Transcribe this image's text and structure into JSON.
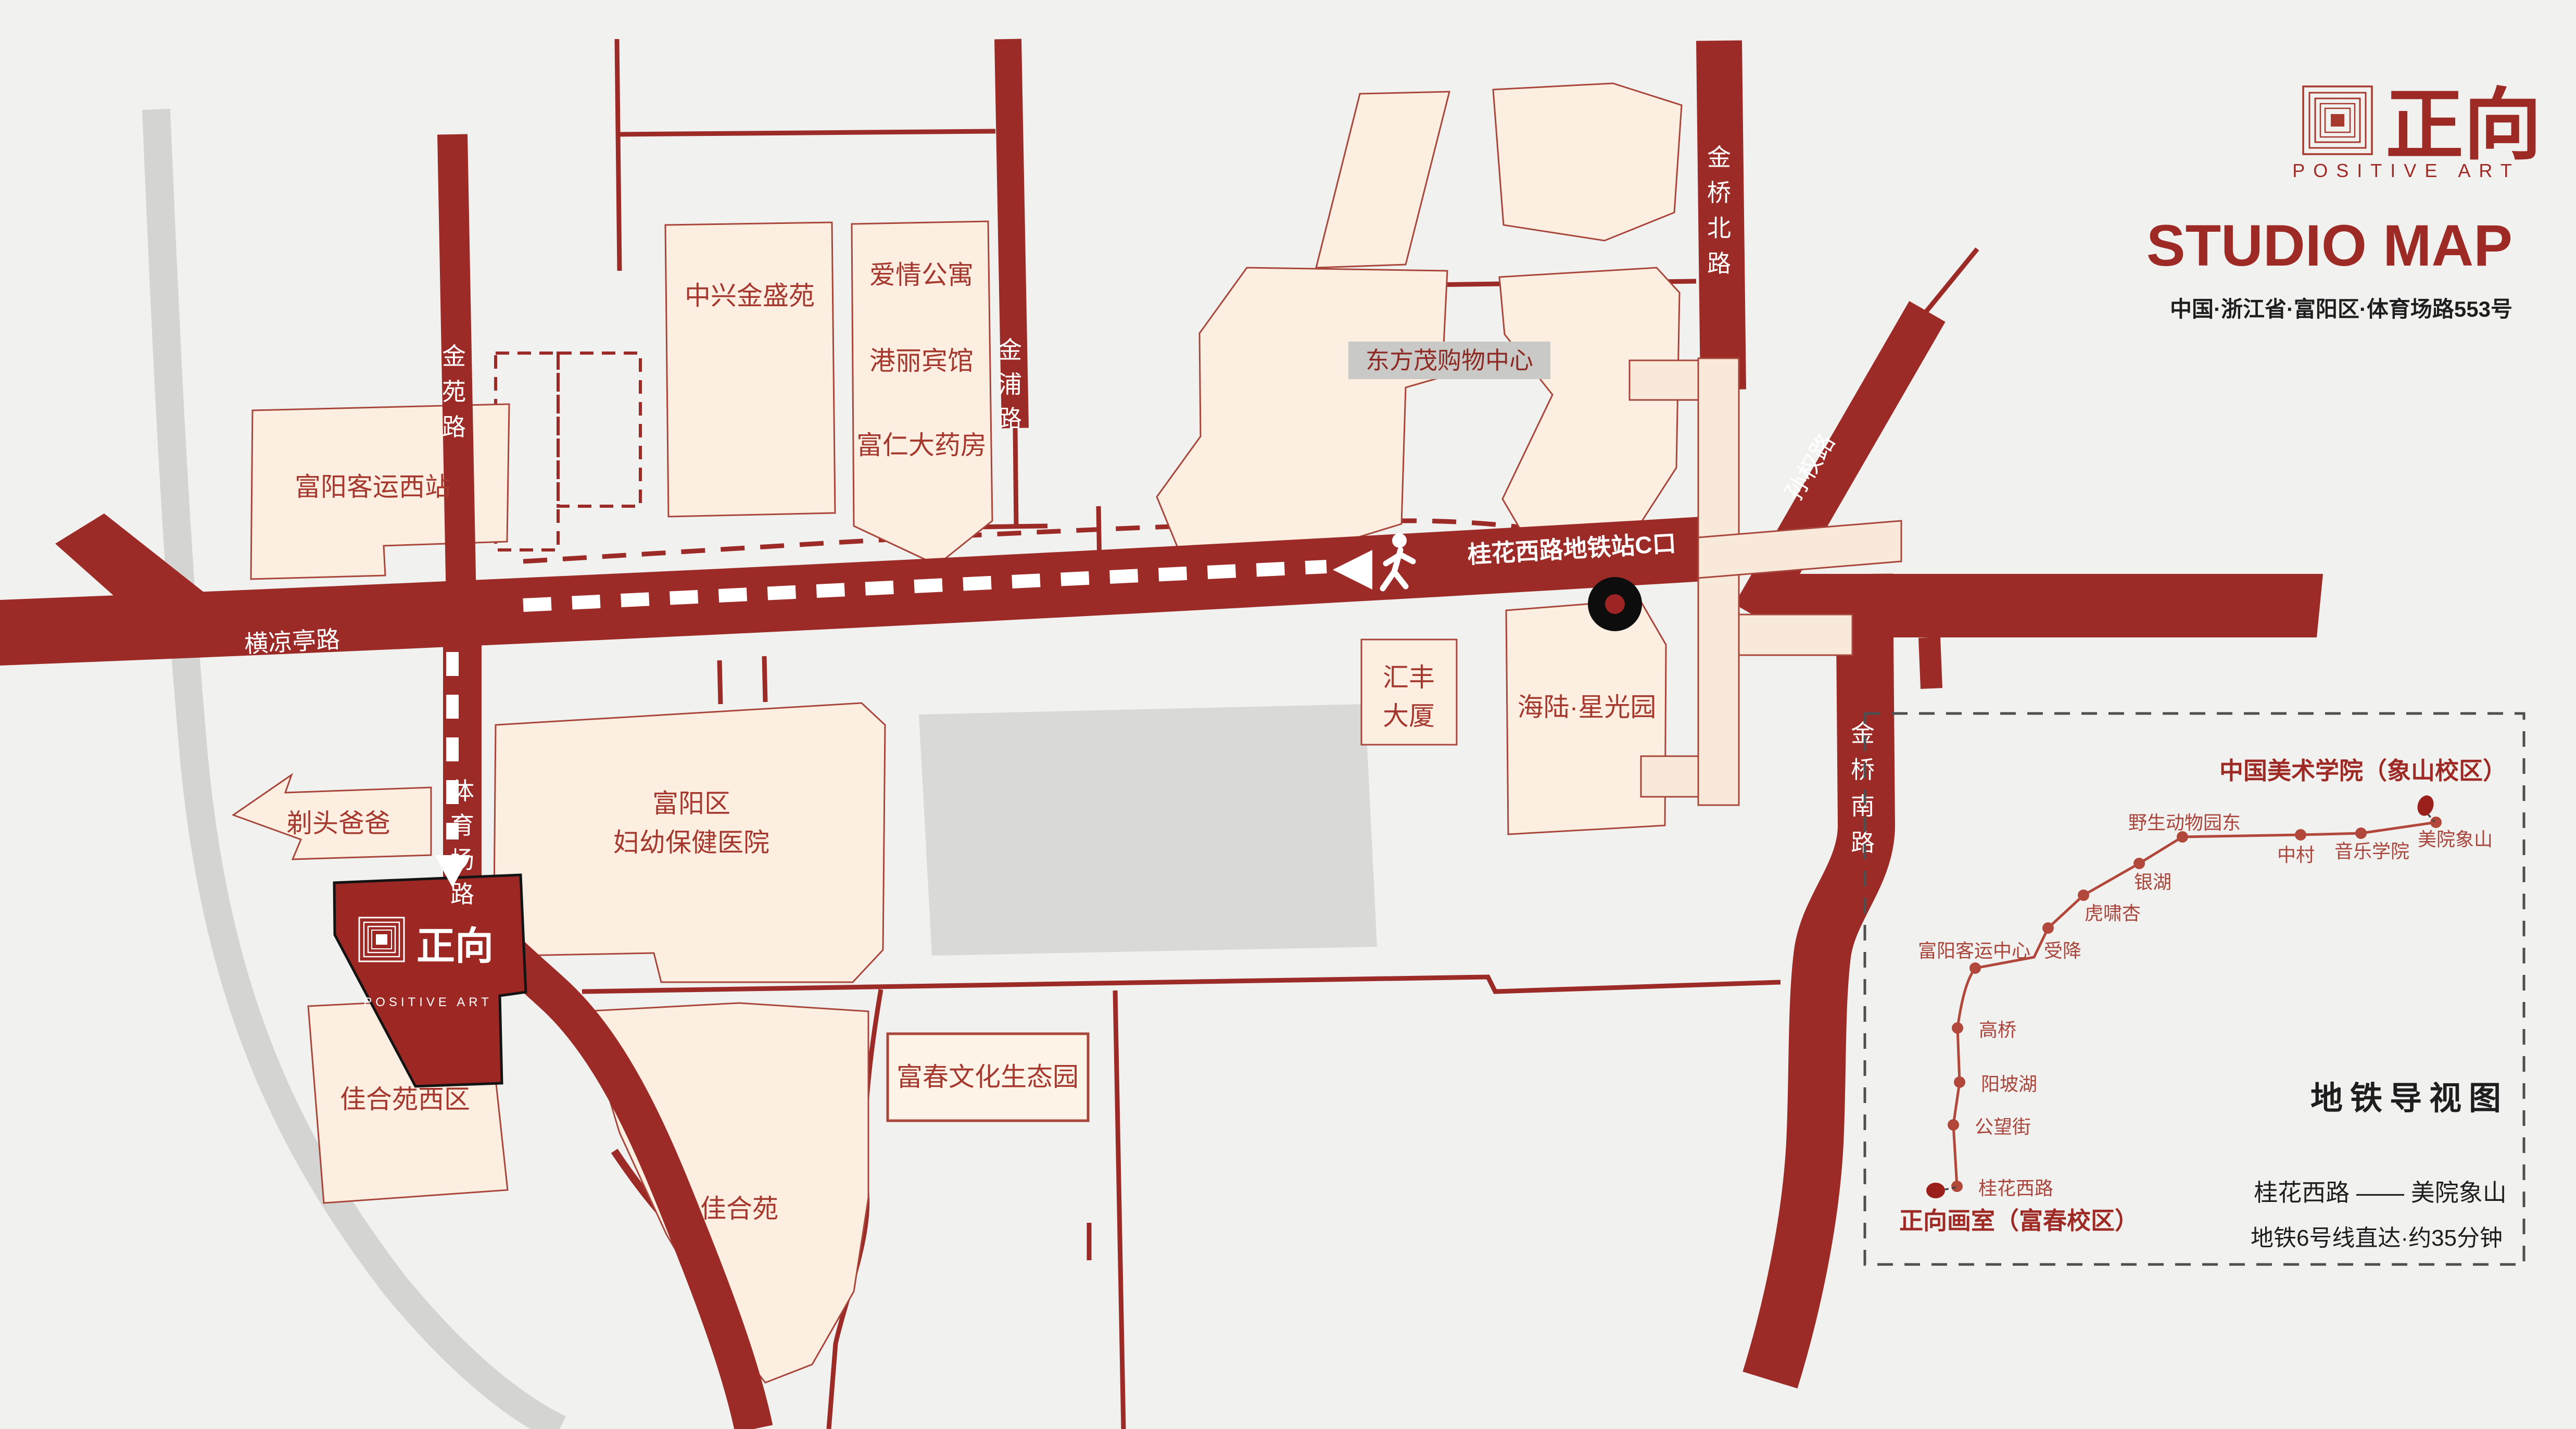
{
  "brand": {
    "name_cn": "正向",
    "name_en": "POSITIVE ART"
  },
  "header": {
    "title": "STUDIO MAP",
    "address": "中国·浙江省·富阳区·体育场路553号"
  },
  "map": {
    "road_labels": {
      "jinyuan": "金苑路",
      "jinpu": "金浦路",
      "jinqiao_north": "金桥北路",
      "sunquan": "孙权路",
      "hengliangting": "横凉亭路",
      "tiyuchang": "体育场路",
      "jinqiao_south": "金桥南路",
      "metro_exit": "桂花西路地铁站C口"
    },
    "buildings": {
      "fuyang_west_bus": "富阳客运西站",
      "zhongxing": "中兴金盛苑",
      "apartment": "爱情公寓",
      "hotel": "港丽宾馆",
      "pharmacy": "富仁大药房",
      "dongfangmao": "东方茂购物中心",
      "huifeng": [
        "汇丰",
        "大厦"
      ],
      "hailu": "海陆·星光园",
      "hospital": [
        "富阳区",
        "妇幼保健医院"
      ],
      "barber": "剃头爸爸",
      "jiaheyuan_west": "佳合苑西区",
      "jiaheyuan": "佳合苑",
      "fuchun_park": "富春文化生态园"
    },
    "studio": {
      "logo_cn": "正向",
      "logo_en": "POSITIVE ART"
    }
  },
  "metro_panel": {
    "dest_title": "中国美术学院（象山校区）",
    "origin_title": "正向画室（富春校区）",
    "panel_title": "地铁导视图",
    "route": "桂花西路 —— 美院象山",
    "note": "地铁6号线直达·约35分钟",
    "stations": [
      "桂花西路",
      "公望街",
      "阳坡湖",
      "高桥",
      "富阳客运中心",
      "受降",
      "虎啸杏",
      "银湖",
      "野生动物园东",
      "中村",
      "音乐学院",
      "美院象山"
    ]
  },
  "colors": {
    "road_red": "#9c2b28",
    "accent_red": "#9e2a26",
    "building_cream": "#fcefe2",
    "metro_line": "#b1483b",
    "gray_road": "#d4d4d3"
  }
}
